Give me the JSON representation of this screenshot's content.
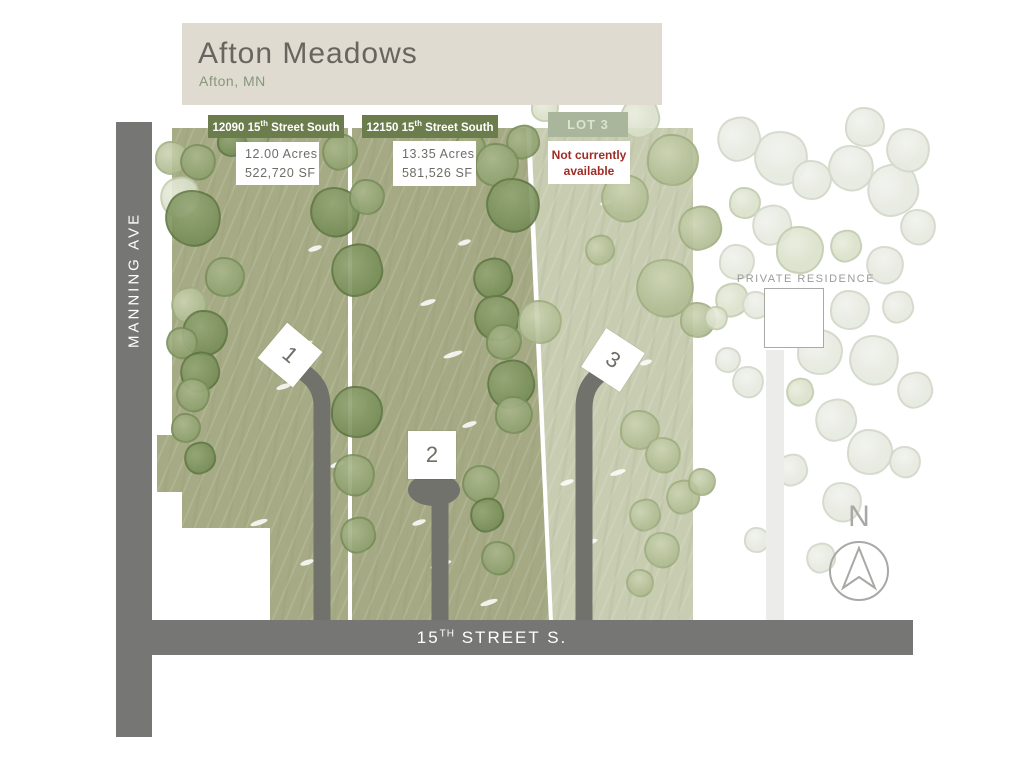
{
  "header": {
    "title": "Afton Meadows",
    "subtitle": "Afton, MN"
  },
  "roads": {
    "vertical_label": "MANNING AVE",
    "horizontal_label_num": "15",
    "horizontal_label_sup": "TH",
    "horizontal_label_rest": " STREET S."
  },
  "lots": [
    {
      "banner_prefix": "12090 15",
      "banner_sup": "th",
      "banner_suffix": " Street South",
      "acres": "12.00 Acres",
      "sf": "522,720 SF",
      "marker": "1"
    },
    {
      "banner_prefix": "12150 15",
      "banner_sup": "th",
      "banner_suffix": " Street South",
      "acres": "13.35 Acres",
      "sf": "581,526 SF",
      "marker": "2"
    },
    {
      "banner_label": "LOT 3",
      "status_line1": "Not currently",
      "status_line2": "available",
      "marker": "3"
    }
  ],
  "private_residence": {
    "label": "PRIVATE RESIDENCE"
  },
  "compass": {
    "label": "N"
  },
  "colors": {
    "header_bg": "#dfdbd1",
    "title_text": "#6a645f",
    "subtitle_green": "#87977a",
    "banner_green": "#6c7d4d",
    "lot3_banner_green": "#a9b69b",
    "unavailable_red": "#9e2d26",
    "road_gray": "#767674",
    "driveway_gray": "#72726d",
    "pale_driveway": "#ececea",
    "lot12_green": "#a6ab85",
    "lot3_green": "#c8cdb2",
    "dark_tree": "#7b915c",
    "medium_tree": "#93a473",
    "sage_tree": "#b3bf96",
    "washed_tree": "#e7eae0",
    "compass_gray": "#a8a8a5"
  },
  "trees": [
    [
      172,
      158,
      17,
      "s"
    ],
    [
      198,
      162,
      18,
      "m"
    ],
    [
      180,
      197,
      20,
      "w2"
    ],
    [
      193,
      218,
      28,
      "d"
    ],
    [
      225,
      277,
      20,
      "m"
    ],
    [
      189,
      305,
      18,
      "s"
    ],
    [
      205,
      333,
      23,
      "d"
    ],
    [
      182,
      343,
      16,
      "m"
    ],
    [
      200,
      372,
      20,
      "d"
    ],
    [
      193,
      395,
      17,
      "m"
    ],
    [
      186,
      428,
      15,
      "m"
    ],
    [
      200,
      458,
      16,
      "d"
    ],
    [
      232,
      142,
      15,
      "d"
    ],
    [
      257,
      136,
      13,
      "m"
    ],
    [
      340,
      152,
      18,
      "m"
    ],
    [
      335,
      212,
      25,
      "d"
    ],
    [
      367,
      197,
      18,
      "m"
    ],
    [
      357,
      270,
      26,
      "d"
    ],
    [
      357,
      412,
      26,
      "d"
    ],
    [
      354,
      475,
      21,
      "m"
    ],
    [
      358,
      535,
      18,
      "m"
    ],
    [
      430,
      165,
      14,
      "m"
    ],
    [
      470,
      148,
      16,
      "m"
    ],
    [
      523,
      142,
      17,
      "m"
    ],
    [
      497,
      165,
      22,
      "m"
    ],
    [
      513,
      205,
      27,
      "d"
    ],
    [
      493,
      278,
      20,
      "d"
    ],
    [
      497,
      318,
      23,
      "d"
    ],
    [
      504,
      342,
      18,
      "m"
    ],
    [
      511,
      384,
      24,
      "d"
    ],
    [
      514,
      415,
      19,
      "m"
    ],
    [
      481,
      484,
      19,
      "m"
    ],
    [
      487,
      515,
      17,
      "d"
    ],
    [
      498,
      558,
      17,
      "m"
    ],
    [
      545,
      108,
      14,
      "w2"
    ],
    [
      640,
      118,
      20,
      "w2"
    ],
    [
      673,
      160,
      26,
      "s"
    ],
    [
      625,
      198,
      24,
      "s"
    ],
    [
      700,
      228,
      22,
      "s"
    ],
    [
      665,
      288,
      29,
      "s"
    ],
    [
      540,
      322,
      22,
      "s"
    ],
    [
      600,
      250,
      15,
      "s"
    ],
    [
      640,
      430,
      20,
      "s"
    ],
    [
      663,
      455,
      18,
      "s"
    ],
    [
      645,
      515,
      16,
      "s"
    ],
    [
      662,
      550,
      18,
      "s"
    ],
    [
      698,
      320,
      18,
      "s"
    ],
    [
      683,
      497,
      17,
      "s"
    ],
    [
      702,
      482,
      14,
      "s"
    ],
    [
      640,
      583,
      14,
      "s"
    ],
    [
      739,
      139,
      22,
      "w1"
    ],
    [
      781,
      158,
      27,
      "w1"
    ],
    [
      745,
      203,
      16,
      "w2"
    ],
    [
      772,
      225,
      20,
      "w1"
    ],
    [
      812,
      180,
      20,
      "w1"
    ],
    [
      851,
      168,
      23,
      "w1"
    ],
    [
      893,
      190,
      26,
      "w1"
    ],
    [
      918,
      227,
      18,
      "w1"
    ],
    [
      800,
      250,
      24,
      "w2"
    ],
    [
      846,
      246,
      16,
      "w2"
    ],
    [
      737,
      262,
      18,
      "w1"
    ],
    [
      885,
      265,
      19,
      "w1"
    ],
    [
      732,
      300,
      17,
      "w2"
    ],
    [
      716,
      318,
      12,
      "w2"
    ],
    [
      850,
      310,
      20,
      "w1"
    ],
    [
      898,
      307,
      16,
      "w1"
    ],
    [
      820,
      352,
      23,
      "w1"
    ],
    [
      874,
      360,
      25,
      "w1"
    ],
    [
      915,
      390,
      18,
      "w1"
    ],
    [
      748,
      382,
      16,
      "w1"
    ],
    [
      728,
      360,
      13,
      "w1"
    ],
    [
      836,
      420,
      21,
      "w1"
    ],
    [
      870,
      452,
      23,
      "w1"
    ],
    [
      905,
      462,
      16,
      "w1"
    ],
    [
      792,
      470,
      16,
      "w1"
    ],
    [
      842,
      502,
      20,
      "w1"
    ],
    [
      757,
      540,
      13,
      "w1"
    ],
    [
      821,
      558,
      15,
      "w1"
    ],
    [
      865,
      127,
      20,
      "w1"
    ],
    [
      908,
      150,
      22,
      "w1"
    ],
    [
      800,
      392,
      14,
      "w2"
    ],
    [
      756,
      305,
      14,
      "w1"
    ]
  ],
  "specks": [
    [
      293,
      342,
      20
    ],
    [
      276,
      384,
      16
    ],
    [
      308,
      246,
      14
    ],
    [
      250,
      520,
      18
    ],
    [
      330,
      462,
      15
    ],
    [
      300,
      560,
      14
    ],
    [
      420,
      300,
      16
    ],
    [
      443,
      352,
      20
    ],
    [
      462,
      422,
      15
    ],
    [
      430,
      562,
      22
    ],
    [
      458,
      240,
      13
    ],
    [
      412,
      520,
      14
    ],
    [
      610,
      470,
      16
    ],
    [
      580,
      540,
      18
    ],
    [
      600,
      200,
      12
    ],
    [
      560,
      480,
      14
    ],
    [
      640,
      360,
      12
    ],
    [
      480,
      600,
      18
    ]
  ]
}
